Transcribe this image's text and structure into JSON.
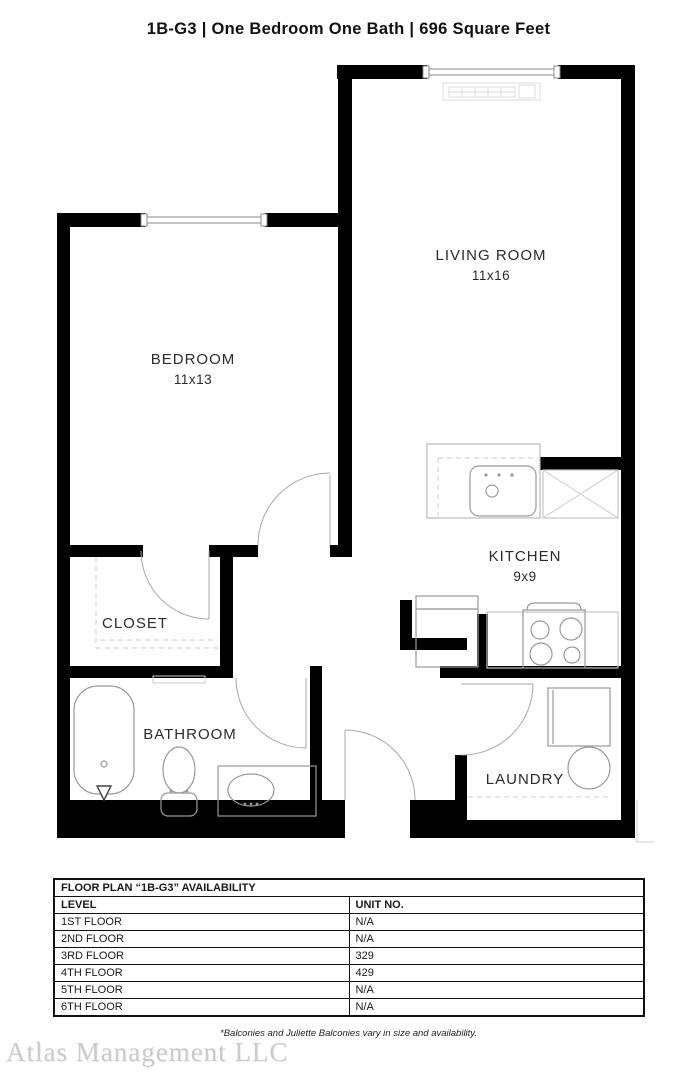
{
  "header": {
    "title": "1B-G3  | One Bedroom One Bath |  696 Square Feet"
  },
  "floor_plan": {
    "rooms": [
      {
        "name": "LIVING ROOM",
        "dimensions": "11x16"
      },
      {
        "name": "BEDROOM",
        "dimensions": "11x13"
      },
      {
        "name": "KITCHEN",
        "dimensions": "9x9"
      },
      {
        "name": "CLOSET",
        "dimensions": ""
      },
      {
        "name": "BATHROOM",
        "dimensions": ""
      },
      {
        "name": "LAUNDRY",
        "dimensions": ""
      }
    ],
    "fixtures": [
      "living-room-window",
      "bedroom-window",
      "baseboard-heater",
      "kitchen-sink",
      "dishwasher-x-cabinet",
      "refrigerator",
      "range",
      "washer",
      "dryer",
      "bathtub",
      "toilet",
      "vanity-sink"
    ],
    "colors": {
      "wall": "#000000",
      "fixture_line": "#9a9a9a",
      "label_text": "#2b2b2b"
    }
  },
  "availability_table": {
    "title": "FLOOR PLAN “1B-G3” AVAILABILITY",
    "columns": [
      "LEVEL",
      "UNIT NO."
    ],
    "rows": [
      {
        "level": "1ST FLOOR",
        "unit": "N/A"
      },
      {
        "level": "2ND FLOOR",
        "unit": "N/A"
      },
      {
        "level": "3RD FLOOR",
        "unit": "329"
      },
      {
        "level": "4TH FLOOR",
        "unit": "429"
      },
      {
        "level": "5TH FLOOR",
        "unit": "N/A"
      },
      {
        "level": "6TH FLOOR",
        "unit": "N/A"
      }
    ]
  },
  "footnote": "*Balconies and Juliette Balconies vary in size and availability.",
  "watermark": "Atlas Management LLC"
}
